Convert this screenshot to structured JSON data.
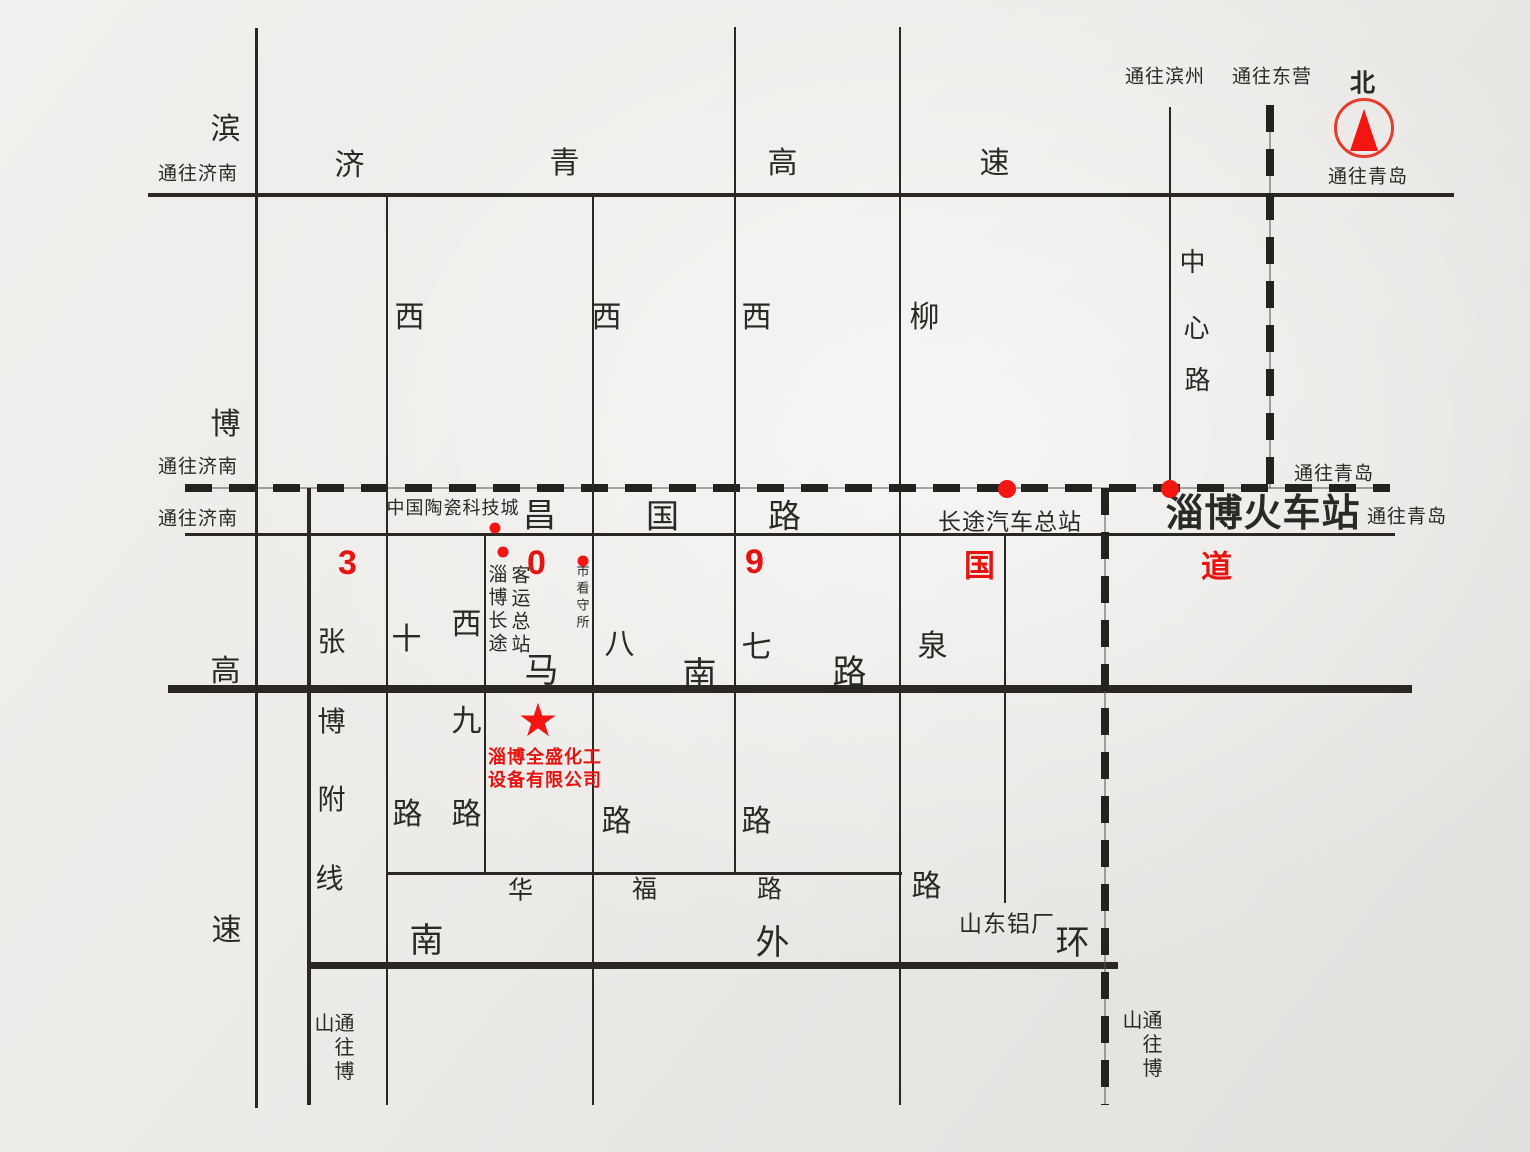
{
  "colors": {
    "paper": "#ecebe8",
    "ink": "#2b2926",
    "red": "#e51410"
  },
  "compass": {
    "x": 1364,
    "y": 128,
    "diameter": 54
  },
  "star": {
    "glyph": "★",
    "x": 538,
    "y": 720,
    "size": 46
  },
  "labels": [
    {
      "name": "road-jiqing-char-ji",
      "t": "济",
      "x": 350,
      "y": 166,
      "s": 30
    },
    {
      "name": "road-jiqing-char-qing",
      "t": "青",
      "x": 565,
      "y": 164,
      "s": 30
    },
    {
      "name": "road-jiqing-char-gao",
      "t": "高",
      "x": 783,
      "y": 164,
      "s": 30
    },
    {
      "name": "road-jiqing-char-su",
      "t": "速",
      "x": 995,
      "y": 164,
      "s": 30
    },
    {
      "name": "road-binbo-char-bin",
      "t": "滨",
      "x": 226,
      "y": 130,
      "s": 30
    },
    {
      "name": "road-binbo-char-bo",
      "t": "博",
      "x": 226,
      "y": 425,
      "s": 30
    },
    {
      "name": "road-binbo-char-gao",
      "t": "高",
      "x": 226,
      "y": 672,
      "s": 30
    },
    {
      "name": "road-binbo-char-su",
      "t": "速",
      "x": 227,
      "y": 931,
      "s": 30
    },
    {
      "name": "dest-jinan-expressway",
      "t": "通往济南",
      "x": 198,
      "y": 174,
      "s": 19
    },
    {
      "name": "dest-jinan-railway",
      "t": "通往济南",
      "x": 198,
      "y": 467,
      "s": 19
    },
    {
      "name": "dest-jinan-changguo",
      "t": "通往济南",
      "x": 198,
      "y": 519,
      "s": 19
    },
    {
      "name": "dest-binzhou",
      "t": "通往滨州",
      "x": 1165,
      "y": 77,
      "s": 19
    },
    {
      "name": "dest-dongying",
      "t": "通往东营",
      "x": 1272,
      "y": 77,
      "s": 19
    },
    {
      "name": "north-label",
      "t": "北",
      "x": 1363,
      "y": 84,
      "s": 25,
      "b": true
    },
    {
      "name": "dest-qingdao-expressway",
      "t": "通往青岛",
      "x": 1368,
      "y": 177,
      "s": 19
    },
    {
      "name": "dest-qingdao-railway",
      "t": "通往青岛",
      "x": 1334,
      "y": 474,
      "s": 19
    },
    {
      "name": "dest-qingdao-changguo",
      "t": "通往青岛",
      "x": 1407,
      "y": 517,
      "s": 19
    },
    {
      "name": "road-xishi-char-xi",
      "t": "西",
      "x": 410,
      "y": 318,
      "s": 30
    },
    {
      "name": "road-xishi-char-shi",
      "t": "十",
      "x": 407,
      "y": 640,
      "s": 30
    },
    {
      "name": "road-xishi-char-lu",
      "t": "路",
      "x": 408,
      "y": 815,
      "s": 30
    },
    {
      "name": "road-xijiu-char-xi",
      "t": "西",
      "x": 467,
      "y": 625,
      "s": 30
    },
    {
      "name": "road-xijiu-char-jiu",
      "t": "九",
      "x": 467,
      "y": 722,
      "s": 30
    },
    {
      "name": "road-xijiu-char-lu",
      "t": "路",
      "x": 467,
      "y": 815,
      "s": 30
    },
    {
      "name": "road-xiba-char-xi",
      "t": "西",
      "x": 607,
      "y": 318,
      "s": 30
    },
    {
      "name": "road-xiba-char-ba",
      "t": "八",
      "x": 620,
      "y": 645,
      "s": 30
    },
    {
      "name": "road-xiba-char-lu",
      "t": "路",
      "x": 617,
      "y": 822,
      "s": 30
    },
    {
      "name": "road-xiqi-char-xi",
      "t": "西",
      "x": 757,
      "y": 318,
      "s": 30
    },
    {
      "name": "road-xiqi-char-qi",
      "t": "七",
      "x": 757,
      "y": 648,
      "s": 30
    },
    {
      "name": "road-xiqi-char-lu",
      "t": "路",
      "x": 757,
      "y": 822,
      "s": 30
    },
    {
      "name": "road-liuquan-char-liu",
      "t": "柳",
      "x": 925,
      "y": 318,
      "s": 30
    },
    {
      "name": "road-liuquan-char-quan",
      "t": "泉",
      "x": 933,
      "y": 647,
      "s": 30
    },
    {
      "name": "road-liuquan-char-lu",
      "t": "路",
      "x": 927,
      "y": 887,
      "s": 30
    },
    {
      "name": "road-zhongxin-char-zhong",
      "t": "中",
      "x": 1193,
      "y": 262,
      "s": 26
    },
    {
      "name": "road-zhongxin-char-xin",
      "t": "心",
      "x": 1197,
      "y": 328,
      "s": 26
    },
    {
      "name": "road-zhongxin-char-lu",
      "t": "路",
      "x": 1198,
      "y": 380,
      "s": 26
    },
    {
      "name": "road-zhangbo-char-zhang",
      "t": "张",
      "x": 332,
      "y": 642,
      "s": 28
    },
    {
      "name": "road-zhangbo-char-bo",
      "t": "博",
      "x": 332,
      "y": 722,
      "s": 28
    },
    {
      "name": "road-zhangbo-char-fu",
      "t": "附",
      "x": 332,
      "y": 800,
      "s": 28
    },
    {
      "name": "road-zhangbo-char-xian",
      "t": "线",
      "x": 330,
      "y": 879,
      "s": 28
    },
    {
      "name": "road-changguo-char-chang",
      "t": "昌",
      "x": 540,
      "y": 515,
      "s": 33
    },
    {
      "name": "road-changguo-char-guo",
      "t": "国",
      "x": 663,
      "y": 516,
      "s": 33
    },
    {
      "name": "road-changguo-char-lu",
      "t": "路",
      "x": 785,
      "y": 516,
      "s": 33
    },
    {
      "name": "g309-digit-3",
      "t": "3",
      "x": 348,
      "y": 563,
      "s": 34,
      "c": "red",
      "b": true
    },
    {
      "name": "g309-digit-0",
      "t": "0",
      "x": 537,
      "y": 563,
      "s": 34,
      "c": "red",
      "b": true
    },
    {
      "name": "g309-digit-9",
      "t": "9",
      "x": 755,
      "y": 562,
      "s": 34,
      "c": "red",
      "b": true
    },
    {
      "name": "g309-char-guo",
      "t": "国",
      "x": 980,
      "y": 566,
      "s": 31,
      "c": "red",
      "b": true
    },
    {
      "name": "g309-char-dao",
      "t": "道",
      "x": 1217,
      "y": 567,
      "s": 31,
      "c": "red",
      "b": true
    },
    {
      "name": "road-manan-char-ma",
      "t": "马",
      "x": 542,
      "y": 671,
      "s": 34
    },
    {
      "name": "road-manan-char-nan",
      "t": "南",
      "x": 700,
      "y": 675,
      "s": 34
    },
    {
      "name": "road-manan-char-lu",
      "t": "路",
      "x": 850,
      "y": 673,
      "s": 34
    },
    {
      "name": "road-huafu-char-hua",
      "t": "华",
      "x": 521,
      "y": 891,
      "s": 25
    },
    {
      "name": "road-huafu-char-fu",
      "t": "福",
      "x": 645,
      "y": 890,
      "s": 25
    },
    {
      "name": "road-huafu-char-lu",
      "t": "路",
      "x": 770,
      "y": 890,
      "s": 25
    },
    {
      "name": "road-nanwaihuan-char-nan",
      "t": "南",
      "x": 427,
      "y": 941,
      "s": 34
    },
    {
      "name": "road-nanwaihuan-char-wai",
      "t": "外",
      "x": 773,
      "y": 943,
      "s": 34
    },
    {
      "name": "road-nanwaihuan-char-huan",
      "t": "环",
      "x": 1073,
      "y": 943,
      "s": 34
    },
    {
      "name": "poi-ceramic-science-city",
      "t": "中国陶瓷科技城",
      "x": 453,
      "y": 508,
      "s": 18
    },
    {
      "name": "poi-coach-terminal-col1",
      "t": "淄博长途",
      "x": 496,
      "y": 610,
      "s": 19,
      "v": true
    },
    {
      "name": "poi-coach-terminal-col2",
      "t": "客运总站",
      "x": 519,
      "y": 611,
      "s": 19,
      "v": true
    },
    {
      "name": "poi-detention-house",
      "t": "市看守所",
      "x": 582,
      "y": 598,
      "s": 13,
      "v": true
    },
    {
      "name": "poi-longdistance-bus-station",
      "t": "长途汽车总站",
      "x": 1010,
      "y": 522,
      "s": 23
    },
    {
      "name": "poi-zibo-train-station",
      "t": "淄博火车站",
      "x": 1263,
      "y": 514,
      "s": 38,
      "b": true
    },
    {
      "name": "poi-shandong-aluminum",
      "t": "山东铝厂",
      "x": 1007,
      "y": 924,
      "s": 23
    },
    {
      "name": "dest-boshan-road",
      "t": "通往博山",
      "x": 332,
      "y": 1059,
      "s": 20,
      "v": true
    },
    {
      "name": "dest-boshan-railway",
      "t": "通往博山",
      "x": 1140,
      "y": 1057,
      "s": 20,
      "v": true
    },
    {
      "name": "company-name-line1",
      "t": "淄博全盛化工",
      "x": 545,
      "y": 757,
      "s": 18,
      "c": "red",
      "b": true
    },
    {
      "name": "company-name-line2",
      "t": "设备有限公司",
      "x": 545,
      "y": 780,
      "s": 18,
      "c": "red",
      "b": true
    }
  ],
  "dots": [
    {
      "name": "dot-ceramic-city",
      "x": 495,
      "y": 528,
      "d": 11
    },
    {
      "name": "dot-coach-terminal",
      "x": 503,
      "y": 552,
      "d": 11
    },
    {
      "name": "dot-detention-house",
      "x": 583,
      "y": 561,
      "d": 11
    },
    {
      "name": "dot-bus-station",
      "x": 1007,
      "y": 489,
      "d": 18
    },
    {
      "name": "dot-train-station",
      "x": 1170,
      "y": 489,
      "d": 18
    }
  ]
}
